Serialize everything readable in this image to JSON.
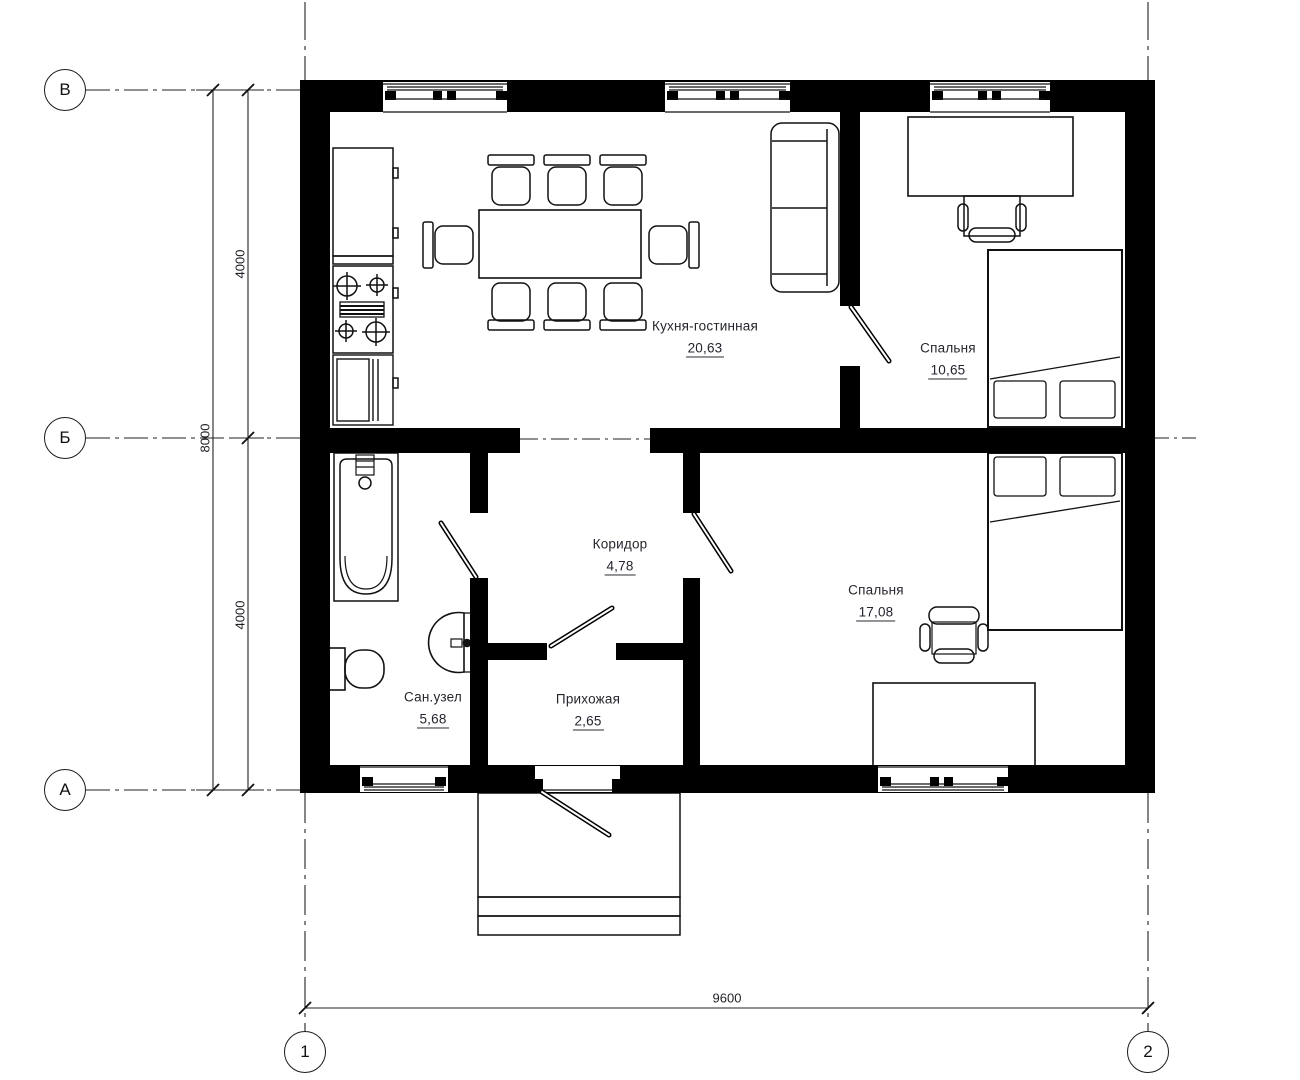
{
  "rooms": [
    {
      "name": "Кухня-гостинная",
      "area": "20,63"
    },
    {
      "name": "Спальня",
      "area": "10,65"
    },
    {
      "name": "Коридор",
      "area": "4,78"
    },
    {
      "name": "Сан.узел",
      "area": "5,68"
    },
    {
      "name": "Прихожая",
      "area": "2,65"
    },
    {
      "name": "Спальня",
      "area": "17,08"
    }
  ],
  "axes": {
    "row_top": "В",
    "row_mid": "Б",
    "row_bottom": "А",
    "col_left": "1",
    "col_right": "2"
  },
  "dimensions": {
    "upper_span": "4000",
    "lower_span": "4000",
    "total_height": "8000",
    "total_width": "9600"
  },
  "colors": {
    "wall": "#000000",
    "background": "#ffffff",
    "line": "#1c1c1c",
    "text": "#25252d"
  }
}
